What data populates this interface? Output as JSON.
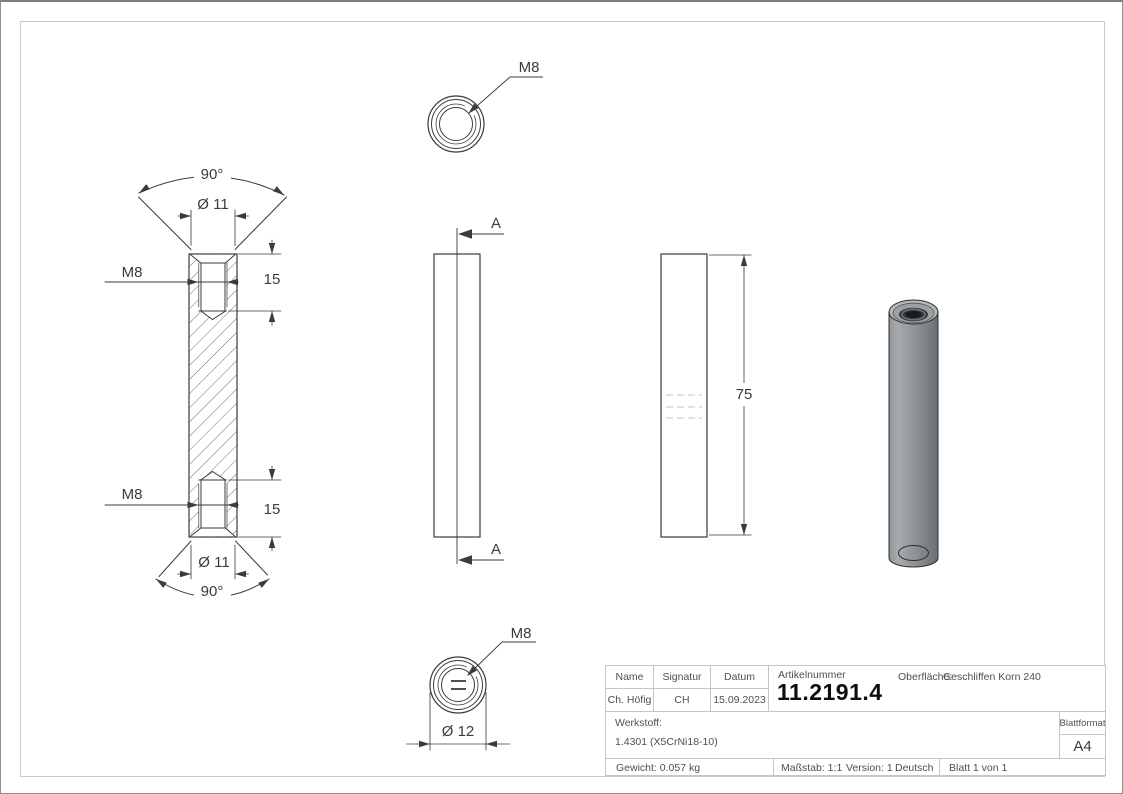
{
  "drawing": {
    "section_view": {
      "angle_top": "90°",
      "dia_top": "Ø 11",
      "thread_top": "M8",
      "depth_top": "15",
      "thread_bottom": "M8",
      "depth_bottom": "15",
      "dia_bottom": "Ø 11",
      "angle_bottom": "90°"
    },
    "top_view": {
      "thread": "M8"
    },
    "front_view": {
      "section_top": "A",
      "section_bottom": "A"
    },
    "side_view": {
      "length": "75"
    },
    "bottom_view": {
      "thread": "M8",
      "dia": "Ø 12"
    }
  },
  "title_block": {
    "headers": {
      "name": "Name",
      "signature": "Signatur",
      "date": "Datum"
    },
    "values": {
      "name": "Ch. Höfig",
      "signature": "CH",
      "date": "15.09.2023"
    },
    "article_label": "Artikelnummer",
    "article_number": "11.2191.4",
    "surface_label": "Oberfläche:",
    "surface_value": "Geschliffen Korn 240",
    "material_label": "Werkstoff:",
    "material_value": "1.4301 (X5CrNi18-10)",
    "weight": "Gewicht: 0.057 kg",
    "scale": "Maßstab: 1:1",
    "version": "Version: 1",
    "language": "Deutsch",
    "sheet": "Blatt 1 von 1",
    "format_label": "Blattformat",
    "format_value": "A4"
  },
  "colors": {
    "line": "#3b3b3b",
    "frame_border": "#c9c9c9",
    "cylinder_gray": "#8f9498"
  }
}
